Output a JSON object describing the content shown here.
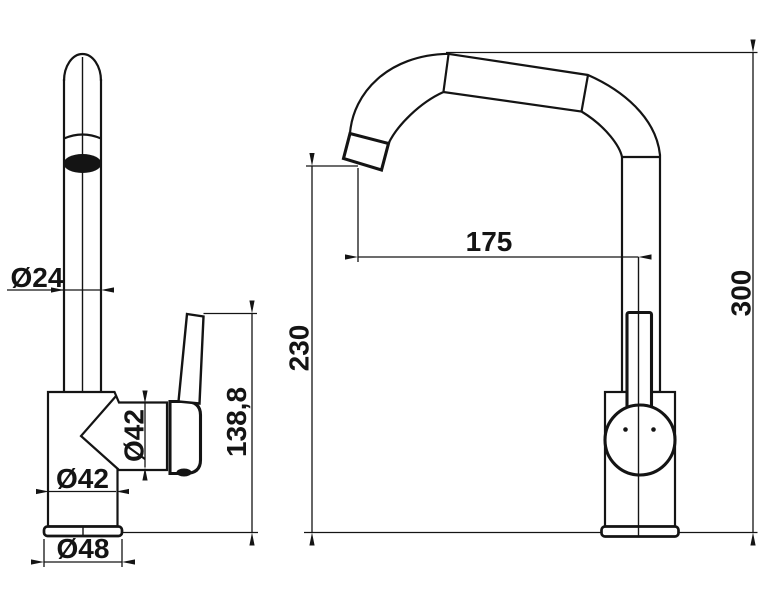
{
  "drawing": {
    "subject": "kitchen faucet technical drawing, front and side views",
    "background_color": "#ffffff",
    "line_color": "#141414"
  },
  "dimensions": {
    "spout_tube_diameter": {
      "label": "Ø24"
    },
    "cartridge_diameter": {
      "label": "Ø42"
    },
    "body_diameter": {
      "label": "Ø42"
    },
    "base_diameter": {
      "label": "Ø48"
    },
    "handle_height": {
      "label": "138,8"
    },
    "spout_reach": {
      "label": "175"
    },
    "spout_outlet_height": {
      "label": "230"
    },
    "overall_height": {
      "label": "300"
    }
  }
}
